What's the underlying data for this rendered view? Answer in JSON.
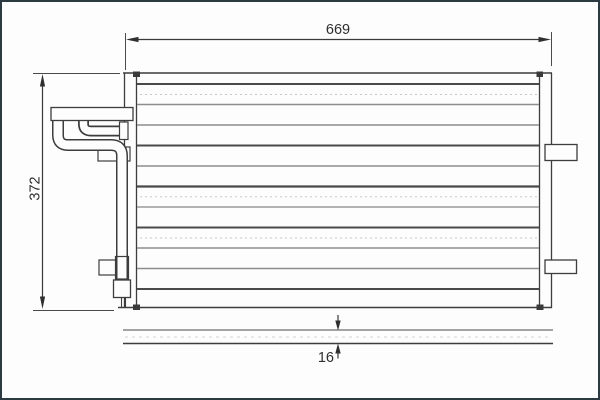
{
  "figure": {
    "type": "technical-drawing",
    "dimensions": {
      "width": "669",
      "height": "372",
      "thickness": "16"
    },
    "colors": {
      "background": "#fdfdfd",
      "frame_border": "#2c3a41",
      "line_dark": "#3d3d3d",
      "line_light": "#8d8d8d",
      "text": "#2e2e2e"
    }
  }
}
